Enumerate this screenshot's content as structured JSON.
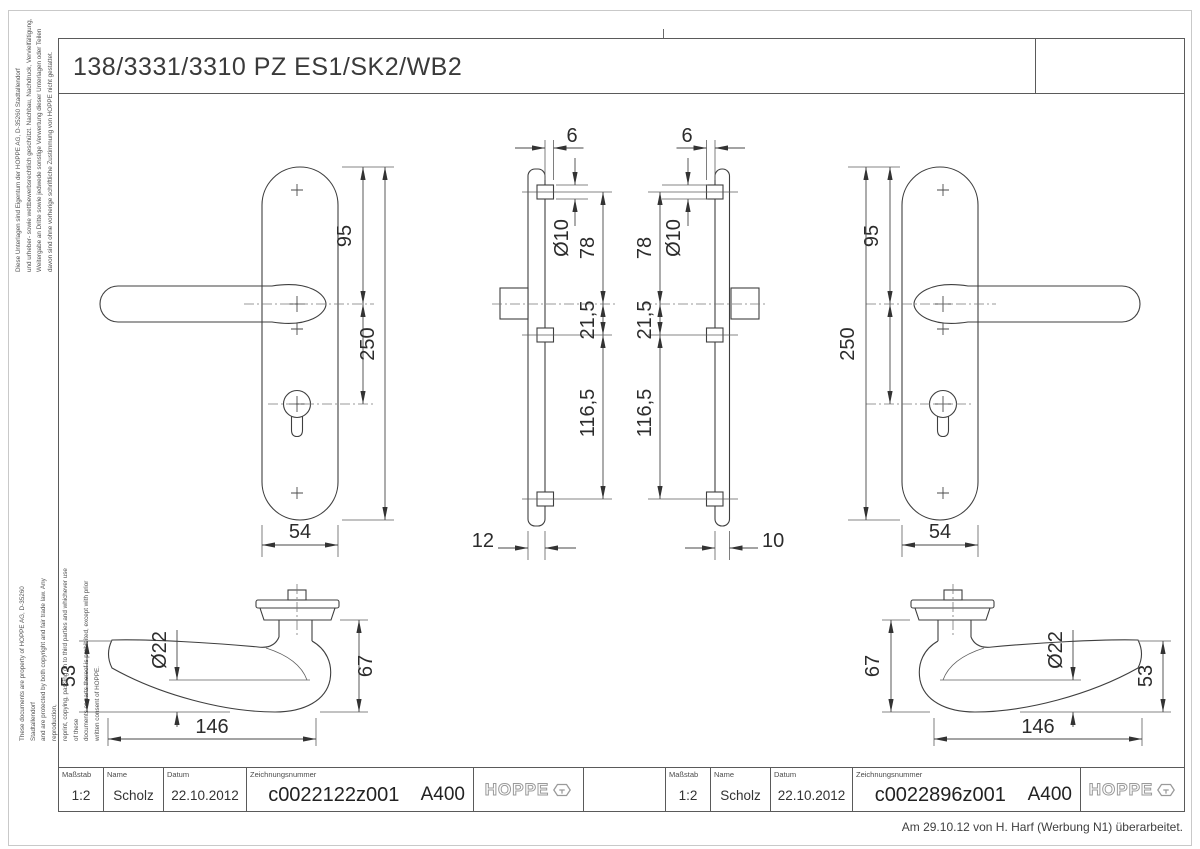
{
  "title_bar": {
    "title": "138/3331/3310 PZ ES1/SK2/WB2"
  },
  "side_notes": {
    "german": "Diese Unterlagen sind Eigentum der  HOPPE AG, D-35260 Stadtallendorf\nund urheber- sowie wettbewerbsrechtlich geschützt. Nachbau, Nachdruck, Vervielfältigung,\nWeitergabe an Dritte sowie jedwede sonstige Verwertung dieser Unterlagen oder Teilen\ndavon sind ohne vorherige schriftliche Zustimmung von HOPPE nicht gestattet.",
    "english": "These documents are property of HOPPE AG, D-35260 Stadtallendorf\nand are protected by both copyright and fair trade law. Any reproduction,\nreprint, copying, passing on to third parties and whichever use of these\ndocuments or parts thereof is prohibited, except with prior written consent of HOPPE."
  },
  "brand": {
    "logo_text": "HOPPE"
  },
  "title_blocks": {
    "left": {
      "scale_label": "Maßstab",
      "scale": "1:2",
      "name_label": "Name",
      "name": "Scholz",
      "date_label": "Datum",
      "date": "22.10.2012",
      "drawing_no_label": "Zeichnungsnummer",
      "drawing_no": "c0022122z001",
      "revision": "A400"
    },
    "right": {
      "scale_label": "Maßstab",
      "scale": "1:2",
      "name_label": "Name",
      "name": "Scholz",
      "date_label": "Datum",
      "date": "22.10.2012",
      "drawing_no_label": "Zeichnungsnummer",
      "drawing_no": "c0022896z001",
      "revision": "A400"
    }
  },
  "footnote": "Am 29.10.12 von H. Harf (Werbung N1) überarbeitet.",
  "dims": {
    "left_plate": {
      "top_to_handle": "95",
      "height": "250",
      "width": "54"
    },
    "right_plate": {
      "top_to_handle": "95",
      "height": "250",
      "width": "54"
    },
    "left_profile": {
      "lug_offset": "6",
      "hole_dia": "Ø10",
      "top_to_handle": "78",
      "handle_to_mid": "21,5",
      "mid_to_bottom": "116,5",
      "thickness": "12"
    },
    "right_profile": {
      "lug_offset": "6",
      "hole_dia": "Ø10",
      "top_to_handle": "78",
      "handle_to_mid": "21,5",
      "mid_to_bottom": "116,5",
      "thickness": "10"
    },
    "left_lever": {
      "end_height": "53",
      "grip_dia": "Ø22",
      "hub_height": "67",
      "length": "146"
    },
    "right_lever": {
      "end_height": "53",
      "grip_dia": "Ø22",
      "hub_height": "67",
      "length": "146"
    }
  }
}
